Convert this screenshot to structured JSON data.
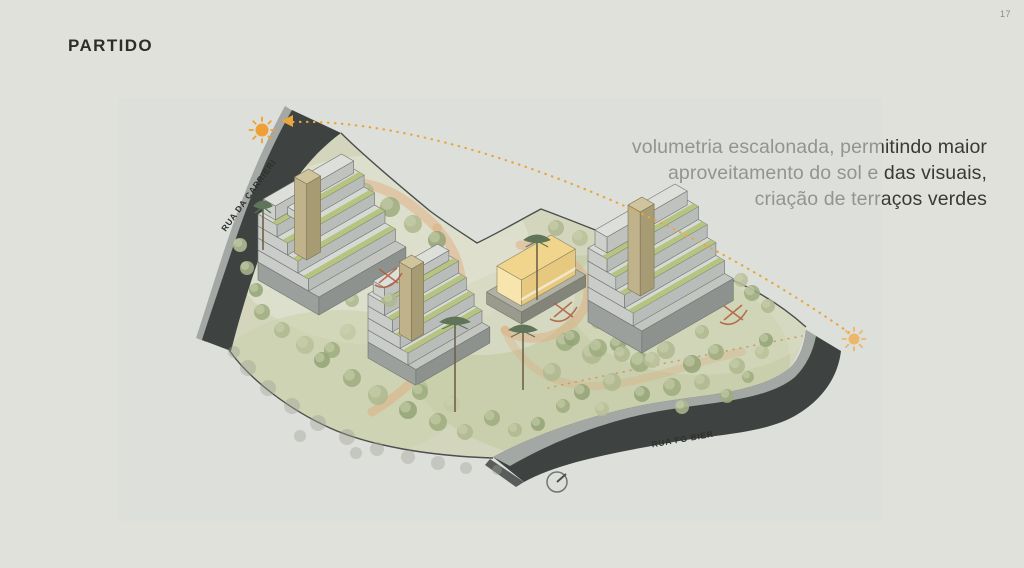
{
  "page": {
    "title": "PARTIDO",
    "page_number": "17"
  },
  "annotation": {
    "lines": [
      "volumetria escalonada, permitindo maior",
      "aproveitamento do sol e das visuais,",
      "criação de terraços verdes"
    ]
  },
  "diagram": {
    "road_labels": {
      "left": "RUA DA CARRIERI",
      "bottom": "RUA FG BIER"
    },
    "icons": {
      "sun_west": "sun-icon",
      "sun_east": "sun-icon",
      "sun_path": "dotted-arc-with-arrow",
      "north_indicator": "circle-with-needle",
      "view_marker": "red-x-with-arc"
    },
    "colors": {
      "background": "#e0e1da",
      "panel": "#d9dedb",
      "road_dark": "#3e4240",
      "road_stripe": "#a3a8a5",
      "site_green": "#d3d6bd",
      "terrace_green": "#b3c078",
      "building_roof": "#d7d9d4",
      "building_sw": "#c9ccc8",
      "building_se": "#b9bdb9",
      "core_tan": "#c0b38b",
      "highlight_yellow": "#f1d58c",
      "sun_orange": "#ef9f35",
      "sun_path_orange": "#e9a63e",
      "path_orange": "#dfa87b",
      "marker_red": "#b05a3c",
      "text_dark": "#3a3a35"
    }
  }
}
